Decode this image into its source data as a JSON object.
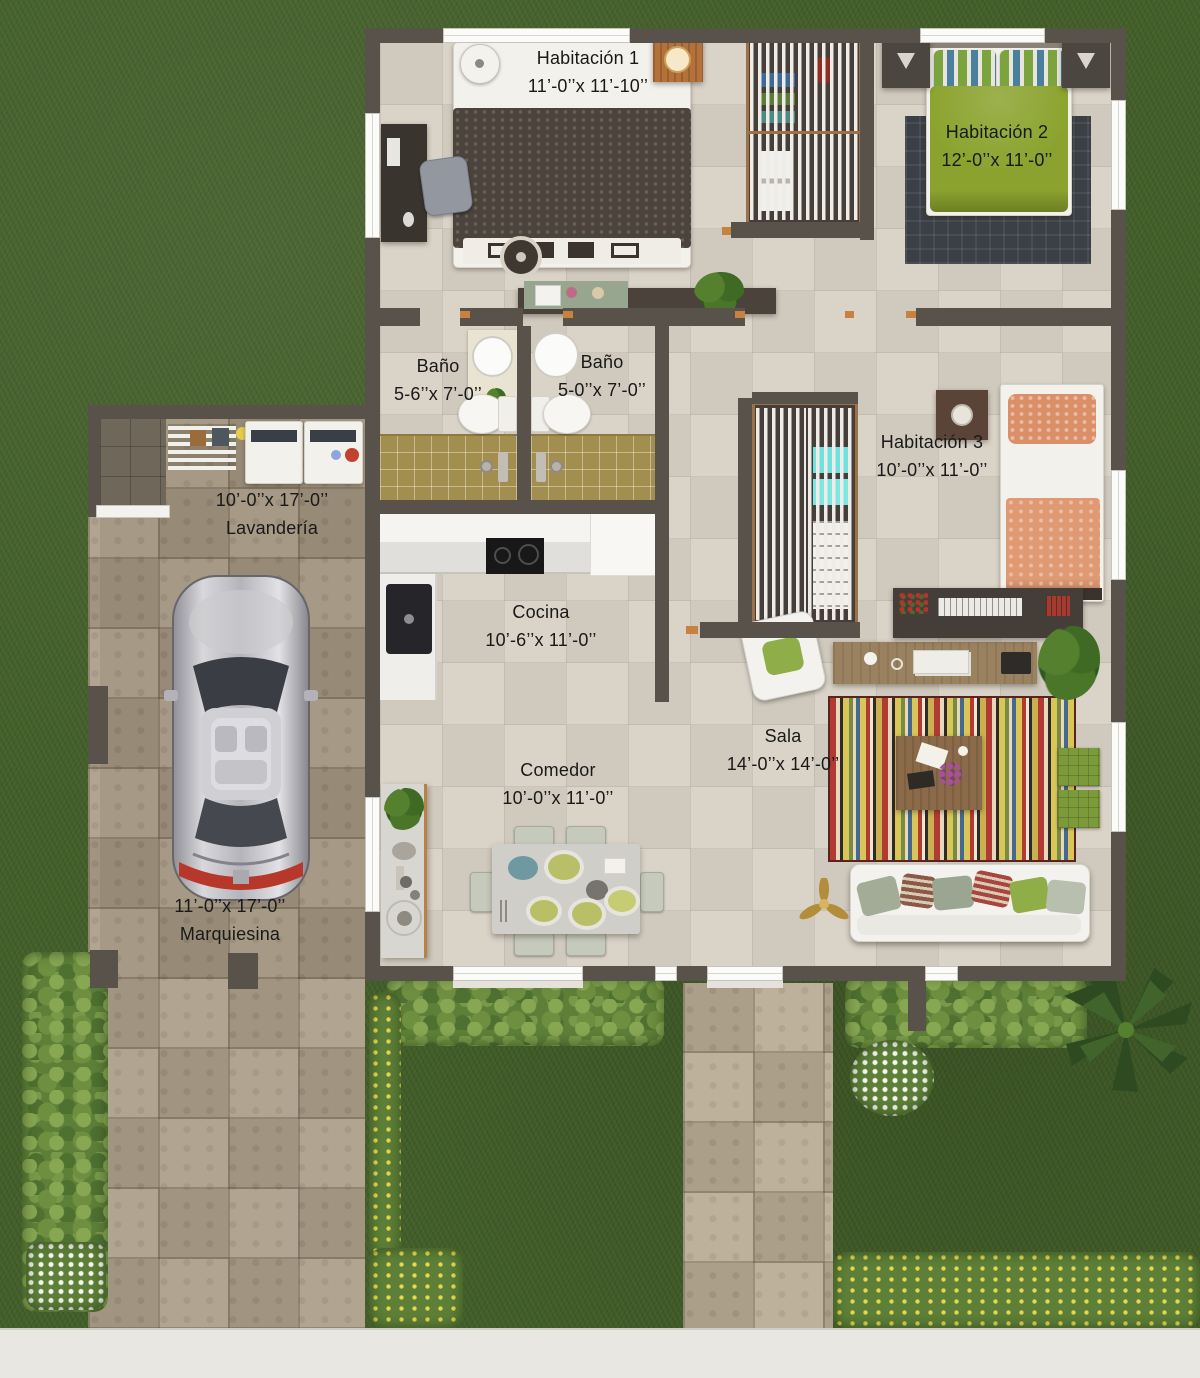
{
  "floorplan": {
    "rooms": {
      "habitacion1": {
        "name": "Habitación 1",
        "dims": "11’-0’’x 11’-10’’"
      },
      "habitacion2": {
        "name": "Habitación 2",
        "dims": "12’-0’’x 11’-0’’"
      },
      "habitacion3": {
        "name": "Habitación 3",
        "dims": "10’-0’’x 11’-0’’"
      },
      "bano1": {
        "name": "Baño",
        "dims": "5-6’’x 7’-0’’"
      },
      "bano2": {
        "name": "Baño",
        "dims": "5-0’’x 7’-0’’"
      },
      "lavanderia": {
        "name": "Lavandería",
        "dims": "10’-0’’x 17’-0’’"
      },
      "cocina": {
        "name": "Cocina",
        "dims": "10’-6’’x 11’-0’’"
      },
      "comedor": {
        "name": "Comedor",
        "dims": "10’-0’’x 11’-0’’"
      },
      "sala": {
        "name": "Sala",
        "dims": "14’-0’’x 14’-0’’"
      },
      "marquesina": {
        "name": "Marquiesina",
        "dims": "11’-0’’x 17’-0’’"
      }
    },
    "palette": {
      "grass": "#44602a",
      "hedge": "#6d8f3f",
      "stone_paving": "#ab9e89",
      "interior_floor": "#d8d1c5",
      "wall": "#59524b",
      "door_threshold": "#c8823f",
      "bath_tile": "#a28e4f",
      "bed2_green": "#8ba32e",
      "bed3_salmon": "#dc8f68",
      "ottoman_green": "#7c9a39",
      "sidewalk": "#e9e7e2",
      "label_text": "#191919"
    }
  }
}
